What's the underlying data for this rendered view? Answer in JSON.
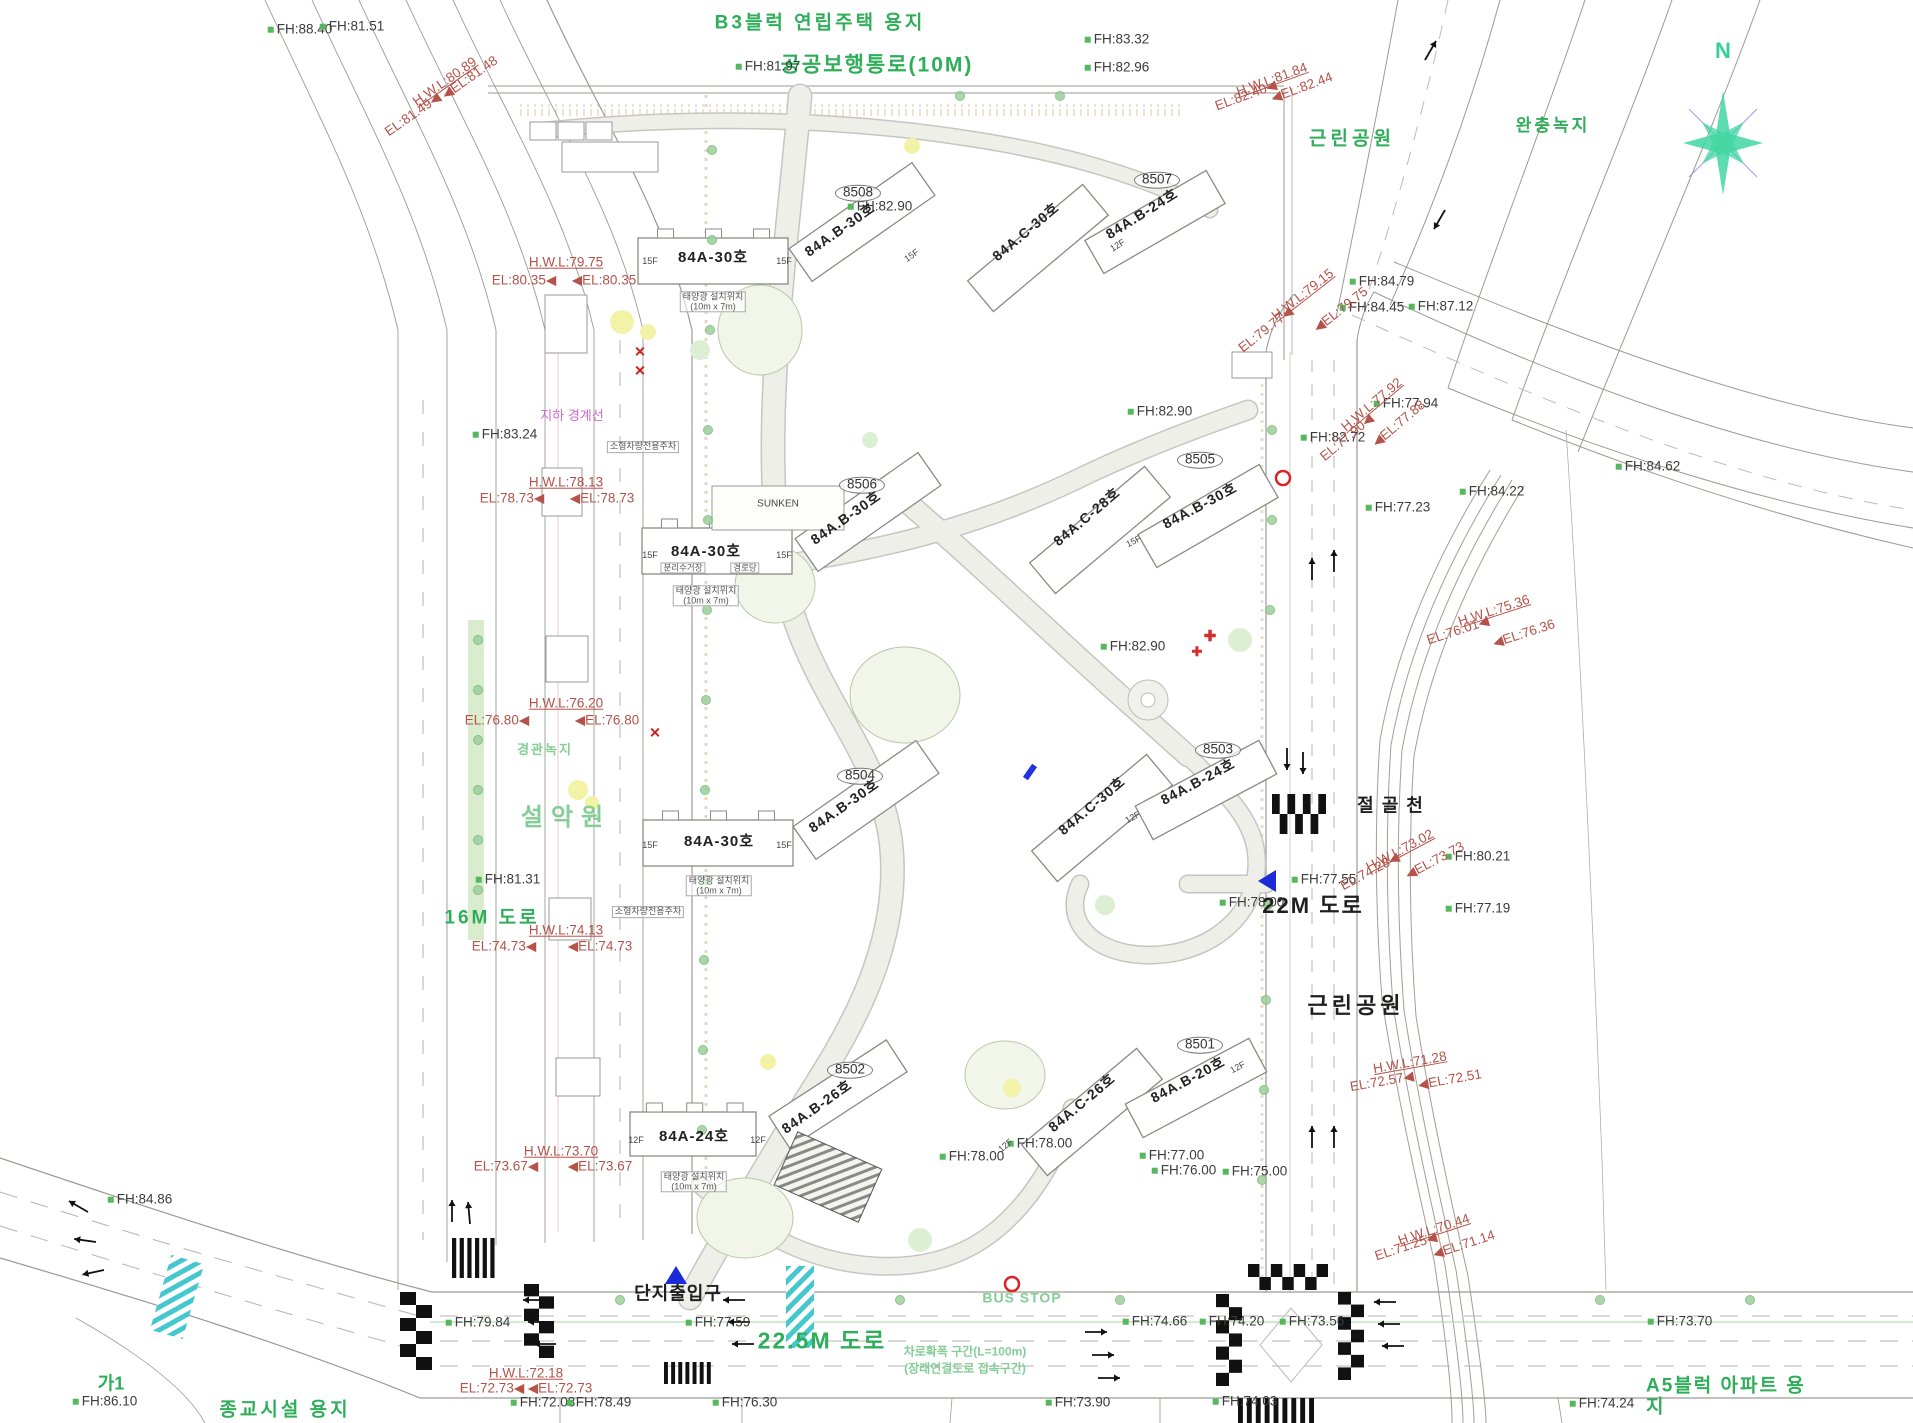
{
  "drawing": {
    "north_label": "N",
    "colors": {
      "area_title_green": "#2fae59",
      "soft_green": "#84cd96",
      "fh_marker_green": "#55b85c",
      "elevation_red": "#b5524a",
      "underground_magenta": "#cf6ad0",
      "compass_teal": "#36d09e",
      "marker_blue": "#1c2bd8",
      "crosswalk_teal": "#45c8cd"
    },
    "annotations": [
      {
        "t": "B3블럭 연립주택 용지",
        "x": 820,
        "y": 24,
        "c": "gt",
        "s": 19,
        "ls": 3
      },
      {
        "t": "공공보행통로(10M)",
        "x": 877,
        "y": 66,
        "c": "gt",
        "s": 21,
        "ls": 2
      },
      {
        "t": "근린공원",
        "x": 1352,
        "y": 140,
        "c": "gt",
        "s": 19,
        "ls": 4
      },
      {
        "t": "완충녹지",
        "x": 1553,
        "y": 126,
        "c": "gt",
        "s": 17,
        "ls": 3
      },
      {
        "t": "근린공원",
        "x": 1356,
        "y": 1006,
        "c": "bk",
        "s": 22,
        "ls": 4
      },
      {
        "t": "22.5M 도로",
        "x": 822,
        "y": 1341,
        "c": "gt",
        "s": 23,
        "ls": 2
      },
      {
        "t": "16M 도로",
        "x": 492,
        "y": 919,
        "c": "gt",
        "s": 19,
        "ls": 3
      },
      {
        "t": "가1",
        "x": 111,
        "y": 1384,
        "c": "gt",
        "s": 18
      },
      {
        "t": "종교시설 용지",
        "x": 285,
        "y": 1411,
        "c": "gt",
        "s": 19,
        "ls": 3
      },
      {
        "t": "A5블럭 아파트 용지",
        "x": 1735,
        "y": 1397,
        "c": "gt",
        "s": 19,
        "ls": 2
      },
      {
        "t": "설악원",
        "x": 566,
        "y": 818,
        "c": "gt2",
        "s": 24,
        "ls": 8
      },
      {
        "t": "경관녹지",
        "x": 545,
        "y": 750,
        "c": "gt2",
        "s": 13,
        "ls": 2
      },
      {
        "t": "BUS STOP",
        "x": 1022,
        "y": 1298,
        "c": "gt2",
        "s": 14,
        "ls": 1
      },
      {
        "t": "차로확폭 구간(L=100m)",
        "x": 965,
        "y": 1352,
        "c": "gt2",
        "s": 12
      },
      {
        "t": "(장래연결도로 접속구간)",
        "x": 965,
        "y": 1369,
        "c": "gt2",
        "s": 12
      },
      {
        "t": "22M 도로",
        "x": 1313,
        "y": 906,
        "c": "bk",
        "s": 22,
        "ls": 2
      },
      {
        "t": "절골천",
        "x": 1394,
        "y": 806,
        "c": "bk",
        "s": 18,
        "ls": 8
      },
      {
        "t": "단지출입구",
        "x": 678,
        "y": 1294,
        "c": "bk",
        "s": 18,
        "ls": 1
      },
      {
        "t": "FH:88.40",
        "x": 300,
        "y": 30,
        "c": "fh"
      },
      {
        "t": "FH:81.51",
        "x": 352,
        "y": 27,
        "c": "fh"
      },
      {
        "t": "FH:81.97",
        "x": 768,
        "y": 67,
        "c": "fh"
      },
      {
        "t": "FH:83.32",
        "x": 1117,
        "y": 40,
        "c": "fh"
      },
      {
        "t": "FH:82.96",
        "x": 1117,
        "y": 68,
        "c": "fh"
      },
      {
        "t": "FH:83.24",
        "x": 505,
        "y": 435,
        "c": "fh"
      },
      {
        "t": "FH:82.90",
        "x": 880,
        "y": 207,
        "c": "fh"
      },
      {
        "t": "FH:82.90",
        "x": 1160,
        "y": 412,
        "c": "fh"
      },
      {
        "t": "FH:82.90",
        "x": 1133,
        "y": 647,
        "c": "fh"
      },
      {
        "t": "FH:84.79",
        "x": 1382,
        "y": 282,
        "c": "fh"
      },
      {
        "t": "FH:84.45",
        "x": 1372,
        "y": 308,
        "c": "fh"
      },
      {
        "t": "FH:87.12",
        "x": 1441,
        "y": 307,
        "c": "fh"
      },
      {
        "t": "FH:77.94",
        "x": 1406,
        "y": 404,
        "c": "fh"
      },
      {
        "t": "FH:82.72",
        "x": 1333,
        "y": 438,
        "c": "fh"
      },
      {
        "t": "FH:84.62",
        "x": 1648,
        "y": 467,
        "c": "fh"
      },
      {
        "t": "FH:84.22",
        "x": 1492,
        "y": 492,
        "c": "fh"
      },
      {
        "t": "FH:77.23",
        "x": 1398,
        "y": 508,
        "c": "fh"
      },
      {
        "t": "FH:81.31",
        "x": 508,
        "y": 880,
        "c": "fh"
      },
      {
        "t": "FH:84.86",
        "x": 140,
        "y": 1200,
        "c": "fh"
      },
      {
        "t": "FH:86.10",
        "x": 105,
        "y": 1402,
        "c": "fh"
      },
      {
        "t": "FH:79.84",
        "x": 478,
        "y": 1323,
        "c": "fh"
      },
      {
        "t": "FH:77.59",
        "x": 718,
        "y": 1323,
        "c": "fh"
      },
      {
        "t": "FH:72.08",
        "x": 543,
        "y": 1403,
        "c": "fh"
      },
      {
        "t": "FH:78.49",
        "x": 599,
        "y": 1403,
        "c": "fh"
      },
      {
        "t": "FH:76.30",
        "x": 745,
        "y": 1403,
        "c": "fh"
      },
      {
        "t": "FH:74.66",
        "x": 1155,
        "y": 1322,
        "c": "fh"
      },
      {
        "t": "FH:74.20",
        "x": 1232,
        "y": 1322,
        "c": "fh"
      },
      {
        "t": "FH:73.56",
        "x": 1312,
        "y": 1322,
        "c": "fh"
      },
      {
        "t": "FH:73.70",
        "x": 1680,
        "y": 1322,
        "c": "fh"
      },
      {
        "t": "FH:73.90",
        "x": 1078,
        "y": 1403,
        "c": "fh"
      },
      {
        "t": "FH:74.03",
        "x": 1245,
        "y": 1402,
        "c": "fh"
      },
      {
        "t": "FH:74.24",
        "x": 1602,
        "y": 1404,
        "c": "fh"
      },
      {
        "t": "FH:78.00",
        "x": 1252,
        "y": 903,
        "c": "fh"
      },
      {
        "t": "FH:77.55",
        "x": 1324,
        "y": 880,
        "c": "fh"
      },
      {
        "t": "FH:78.00",
        "x": 1040,
        "y": 1144,
        "c": "fh"
      },
      {
        "t": "FH:78.00",
        "x": 972,
        "y": 1157,
        "c": "fh"
      },
      {
        "t": "FH:77.00",
        "x": 1172,
        "y": 1156,
        "c": "fh"
      },
      {
        "t": "FH:76.00",
        "x": 1184,
        "y": 1171,
        "c": "fh"
      },
      {
        "t": "FH:75.00",
        "x": 1255,
        "y": 1172,
        "c": "fh"
      },
      {
        "t": "FH:80.21",
        "x": 1478,
        "y": 857,
        "c": "fh"
      },
      {
        "t": "FH:77.19",
        "x": 1478,
        "y": 909,
        "c": "fh"
      },
      {
        "t": "H.W.L:80.89",
        "x": 445,
        "y": 82,
        "c": "elu",
        "r": -35
      },
      {
        "t": "EL:81.49◀",
        "x": 413,
        "y": 115,
        "c": "el",
        "r": -35
      },
      {
        "t": "◀EL:81.48",
        "x": 470,
        "y": 78,
        "c": "el",
        "r": -35
      },
      {
        "t": "H.W.L:81.84",
        "x": 1272,
        "y": 80,
        "c": "elu",
        "r": -20
      },
      {
        "t": "EL:82.40◀",
        "x": 1246,
        "y": 96,
        "c": "el",
        "r": -20
      },
      {
        "t": "◀EL:82.44",
        "x": 1302,
        "y": 88,
        "c": "el",
        "r": -20
      },
      {
        "t": "H.W.L:79.75",
        "x": 566,
        "y": 263,
        "c": "elu"
      },
      {
        "t": "EL:80.35◀",
        "x": 524,
        "y": 281,
        "c": "el"
      },
      {
        "t": "◀EL:80.35",
        "x": 604,
        "y": 281,
        "c": "el"
      },
      {
        "t": "H.W.L:78.13",
        "x": 566,
        "y": 483,
        "c": "elu"
      },
      {
        "t": "EL:78.73◀",
        "x": 512,
        "y": 499,
        "c": "el"
      },
      {
        "t": "◀EL:78.73",
        "x": 602,
        "y": 499,
        "c": "el"
      },
      {
        "t": "H.W.L:76.20",
        "x": 566,
        "y": 704,
        "c": "elu"
      },
      {
        "t": "EL:76.80◀",
        "x": 497,
        "y": 721,
        "c": "el"
      },
      {
        "t": "◀EL:76.80",
        "x": 607,
        "y": 721,
        "c": "el"
      },
      {
        "t": "H.W.L:74.13",
        "x": 566,
        "y": 931,
        "c": "elu"
      },
      {
        "t": "EL:74.73◀",
        "x": 504,
        "y": 947,
        "c": "el"
      },
      {
        "t": "◀EL:74.73",
        "x": 600,
        "y": 947,
        "c": "el"
      },
      {
        "t": "H.W.L:73.70",
        "x": 561,
        "y": 1152,
        "c": "elu"
      },
      {
        "t": "EL:73.67◀",
        "x": 506,
        "y": 1167,
        "c": "el"
      },
      {
        "t": "◀EL:73.67",
        "x": 600,
        "y": 1167,
        "c": "el"
      },
      {
        "t": "H.W.L:72.18",
        "x": 526,
        "y": 1374,
        "c": "elu"
      },
      {
        "t": "EL:72.73◀",
        "x": 492,
        "y": 1389,
        "c": "el"
      },
      {
        "t": "◀EL:72.73",
        "x": 560,
        "y": 1389,
        "c": "el"
      },
      {
        "t": "H.W.L:79.15",
        "x": 1303,
        "y": 295,
        "c": "elu",
        "r": -38
      },
      {
        "t": "EL:79.77◀",
        "x": 1266,
        "y": 330,
        "c": "el",
        "r": -38
      },
      {
        "t": "◀EL:79.75",
        "x": 1341,
        "y": 310,
        "c": "el",
        "r": -38
      },
      {
        "t": "H.W.L:77.92",
        "x": 1372,
        "y": 405,
        "c": "elu",
        "r": -40
      },
      {
        "t": "EL:77.90◀",
        "x": 1347,
        "y": 438,
        "c": "el",
        "r": -40
      },
      {
        "t": "◀EL:77.88",
        "x": 1399,
        "y": 424,
        "c": "el",
        "r": -40
      },
      {
        "t": "H.W.L:75.36",
        "x": 1494,
        "y": 611,
        "c": "elu",
        "r": -18
      },
      {
        "t": "EL:76.01◀",
        "x": 1458,
        "y": 631,
        "c": "el",
        "r": -18
      },
      {
        "t": "◀EL:76.36",
        "x": 1524,
        "y": 634,
        "c": "el",
        "r": -18
      },
      {
        "t": "H.W.L:73.02",
        "x": 1400,
        "y": 851,
        "c": "elu",
        "r": -28
      },
      {
        "t": "EL:74.28◀",
        "x": 1370,
        "y": 872,
        "c": "el",
        "r": -28
      },
      {
        "t": "◀EL:73.73",
        "x": 1435,
        "y": 861,
        "c": "el",
        "r": -28
      },
      {
        "t": "H.W.L:71.28",
        "x": 1410,
        "y": 1063,
        "c": "elu",
        "r": -10
      },
      {
        "t": "EL:72.57◀",
        "x": 1382,
        "y": 1082,
        "c": "el",
        "r": -10
      },
      {
        "t": "◀EL:72.51",
        "x": 1450,
        "y": 1080,
        "c": "el",
        "r": -10
      },
      {
        "t": "H.W.L:70.44",
        "x": 1434,
        "y": 1230,
        "c": "elu",
        "r": -18
      },
      {
        "t": "EL:71.25◀",
        "x": 1406,
        "y": 1247,
        "c": "el",
        "r": -18
      },
      {
        "t": "◀EL:71.14",
        "x": 1464,
        "y": 1245,
        "c": "el",
        "r": -18
      },
      {
        "t": "지하 경계선",
        "x": 572,
        "y": 416,
        "c": "mg",
        "s": 13
      },
      {
        "t": "8508",
        "x": 858,
        "y": 193,
        "c": "bid"
      },
      {
        "t": "8507",
        "x": 1157,
        "y": 180,
        "c": "bid"
      },
      {
        "t": "8506",
        "x": 862,
        "y": 485,
        "c": "bid"
      },
      {
        "t": "8505",
        "x": 1200,
        "y": 460,
        "c": "bid"
      },
      {
        "t": "8504",
        "x": 860,
        "y": 776,
        "c": "bid"
      },
      {
        "t": "8503",
        "x": 1218,
        "y": 750,
        "c": "bid"
      },
      {
        "t": "8502",
        "x": 850,
        "y": 1070,
        "c": "bid"
      },
      {
        "t": "8501",
        "x": 1200,
        "y": 1045,
        "c": "bid"
      },
      {
        "t": "84A-30호",
        "x": 713,
        "y": 258,
        "c": "unit",
        "s": 15
      },
      {
        "t": "84A-30호",
        "x": 706,
        "y": 552,
        "c": "unit",
        "s": 15
      },
      {
        "t": "84A-30호",
        "x": 719,
        "y": 842,
        "c": "unit",
        "s": 15
      },
      {
        "t": "84A-24호",
        "x": 694,
        "y": 1137,
        "c": "unit",
        "s": 15
      },
      {
        "t": "84A.B-30호",
        "x": 840,
        "y": 230,
        "c": "unit",
        "s": 14,
        "r": -35
      },
      {
        "t": "84A.B-30호",
        "x": 846,
        "y": 518,
        "c": "unit",
        "s": 14,
        "r": -35
      },
      {
        "t": "84A.B-30호",
        "x": 844,
        "y": 806,
        "c": "unit",
        "s": 14,
        "r": -35
      },
      {
        "t": "84A.B-30호",
        "x": 1200,
        "y": 506,
        "c": "unit",
        "s": 14,
        "r": -28
      },
      {
        "t": "84A.C-30호",
        "x": 1026,
        "y": 232,
        "c": "unit",
        "s": 14,
        "r": -40
      },
      {
        "t": "84A.C-30호",
        "x": 1092,
        "y": 806,
        "c": "unit",
        "s": 14,
        "r": -40
      },
      {
        "t": "84A.B-24호",
        "x": 1142,
        "y": 214,
        "c": "unit",
        "s": 14,
        "r": -32
      },
      {
        "t": "84A.B-24호",
        "x": 1198,
        "y": 782,
        "c": "unit",
        "s": 14,
        "r": -28
      },
      {
        "t": "84A.C-28호",
        "x": 1087,
        "y": 517,
        "c": "unit",
        "s": 14,
        "r": -40
      },
      {
        "t": "84A.B-26호",
        "x": 817,
        "y": 1107,
        "c": "unit",
        "s": 14,
        "r": -35
      },
      {
        "t": "84A.C-26호",
        "x": 1082,
        "y": 1103,
        "c": "unit",
        "s": 14,
        "r": -40
      },
      {
        "t": "84A.B-20호",
        "x": 1188,
        "y": 1080,
        "c": "unit",
        "s": 14,
        "r": -28
      },
      {
        "t": "SUNKEN",
        "x": 778,
        "y": 505,
        "c": "fl",
        "s": 10
      },
      {
        "t": "15F",
        "x": 650,
        "y": 262,
        "c": "fl",
        "s": 9
      },
      {
        "t": "15F",
        "x": 784,
        "y": 262,
        "c": "fl",
        "s": 9
      },
      {
        "t": "15F",
        "x": 650,
        "y": 556,
        "c": "fl",
        "s": 9
      },
      {
        "t": "15F",
        "x": 784,
        "y": 556,
        "c": "fl",
        "s": 9
      },
      {
        "t": "15F",
        "x": 650,
        "y": 846,
        "c": "fl",
        "s": 9
      },
      {
        "t": "15F",
        "x": 784,
        "y": 846,
        "c": "fl",
        "s": 9
      },
      {
        "t": "12F",
        "x": 636,
        "y": 1141,
        "c": "fl",
        "s": 9
      },
      {
        "t": "12F",
        "x": 758,
        "y": 1141,
        "c": "fl",
        "s": 9
      },
      {
        "t": "15F",
        "x": 912,
        "y": 256,
        "c": "fl",
        "s": 9,
        "r": -35
      },
      {
        "t": "12F",
        "x": 1118,
        "y": 246,
        "c": "fl",
        "s": 9,
        "r": -32
      },
      {
        "t": "15F",
        "x": 1134,
        "y": 542,
        "c": "fl",
        "s": 9,
        "r": -28
      },
      {
        "t": "12F",
        "x": 1133,
        "y": 818,
        "c": "fl",
        "s": 9,
        "r": -28
      },
      {
        "t": "12F",
        "x": 1006,
        "y": 1146,
        "c": "fl",
        "s": 9,
        "r": -40
      },
      {
        "t": "12F",
        "x": 1238,
        "y": 1068,
        "c": "fl",
        "s": 9,
        "r": -28
      },
      {
        "t": "태양광 설치위치\n(10m x 7m)",
        "x": 713,
        "y": 302,
        "c": "sm",
        "s": 9
      },
      {
        "t": "태양광 설치위치\n(10m x 7m)",
        "x": 706,
        "y": 596,
        "c": "sm",
        "s": 9
      },
      {
        "t": "태양광 설치위치\n(10m x 7m)",
        "x": 719,
        "y": 886,
        "c": "sm",
        "s": 9
      },
      {
        "t": "태양광 설치위치\n(10m x 7m)",
        "x": 694,
        "y": 1182,
        "c": "sm",
        "s": 9
      },
      {
        "t": "소형차량전용주차",
        "x": 643,
        "y": 447,
        "c": "sm",
        "s": 9
      },
      {
        "t": "소형차량전용주차",
        "x": 648,
        "y": 912,
        "c": "sm",
        "s": 9
      },
      {
        "t": "분리수거장",
        "x": 683,
        "y": 568,
        "c": "sm",
        "s": 8.5
      },
      {
        "t": "경로당",
        "x": 745,
        "y": 568,
        "c": "sm",
        "s": 8.5
      },
      {
        "t": "✕",
        "x": 640,
        "y": 352,
        "c": "rx",
        "s": 14
      },
      {
        "t": "✕",
        "x": 640,
        "y": 371,
        "c": "rx",
        "s": 14
      },
      {
        "t": "✕",
        "x": 655,
        "y": 733,
        "c": "rx",
        "s": 14
      },
      {
        "t": "✚",
        "x": 1210,
        "y": 637,
        "c": "rc",
        "s": 15
      },
      {
        "t": "✚",
        "x": 1197,
        "y": 652,
        "c": "rc",
        "s": 13
      }
    ]
  }
}
